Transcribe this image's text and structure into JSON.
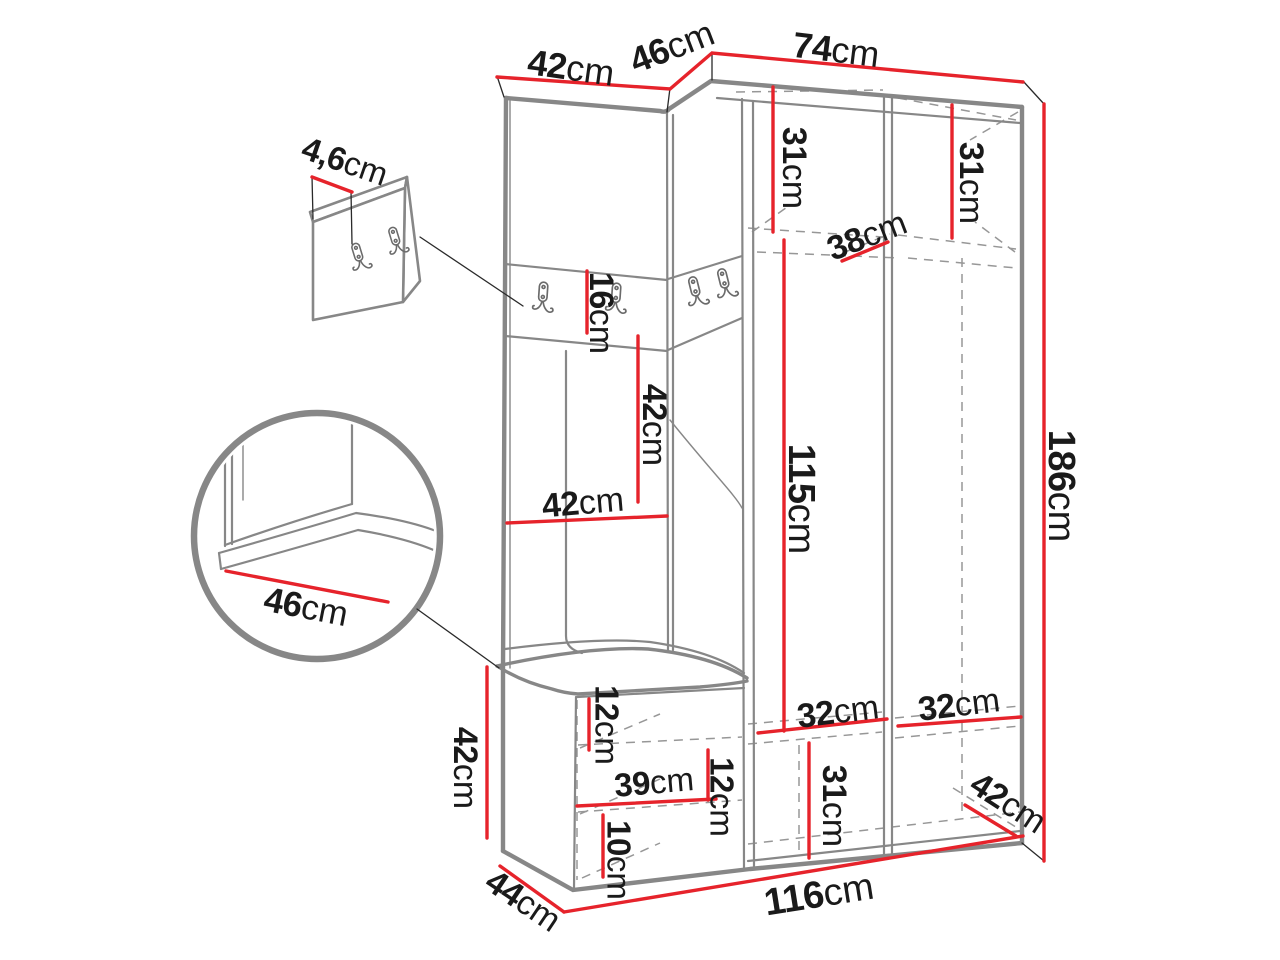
{
  "diagram": {
    "type": "furniture-dimension-drawing",
    "subject": "Corner hallway wardrobe set with coat hook panels, upholstered bench and shoe storage",
    "unit": "cm",
    "colors": {
      "background": "#ffffff",
      "outline_gray": "#878787",
      "hidden_line_gray": "#979797",
      "dimension_red": "#e6232b",
      "label_black": "#1a1a1a",
      "hook_gray": "#6b6b6b"
    },
    "icons": [
      "coat-hook-icon"
    ],
    "dimensions": [
      {
        "id": "width-left-section",
        "value": "42",
        "unit": "cm"
      },
      {
        "id": "width-corner-section",
        "value": "46",
        "unit": "cm"
      },
      {
        "id": "width-wardrobe",
        "value": "74",
        "unit": "cm"
      },
      {
        "id": "hook-panel-thickness",
        "value": "4,6",
        "unit": "cm"
      },
      {
        "id": "top-shelf-height-left",
        "value": "31",
        "unit": "cm"
      },
      {
        "id": "top-shelf-height-right",
        "value": "31",
        "unit": "cm"
      },
      {
        "id": "top-shelf-depth",
        "value": "38",
        "unit": "cm"
      },
      {
        "id": "hook-strip-height",
        "value": "16",
        "unit": "cm"
      },
      {
        "id": "back-panel-height",
        "value": "42",
        "unit": "cm"
      },
      {
        "id": "back-panel-width",
        "value": "42",
        "unit": "cm"
      },
      {
        "id": "hanging-space-height",
        "value": "115",
        "unit": "cm"
      },
      {
        "id": "total-height",
        "value": "186",
        "unit": "cm"
      },
      {
        "id": "bench-seat-depth",
        "value": "46",
        "unit": "cm"
      },
      {
        "id": "bench-height",
        "value": "42",
        "unit": "cm"
      },
      {
        "id": "bench-shelf-gap-upper",
        "value": "12",
        "unit": "cm"
      },
      {
        "id": "bench-inner-width",
        "value": "39",
        "unit": "cm"
      },
      {
        "id": "bench-shelf-gap-lower",
        "value": "12",
        "unit": "cm"
      },
      {
        "id": "bench-bottom-shelf-height",
        "value": "10",
        "unit": "cm"
      },
      {
        "id": "door-inner-width-left",
        "value": "32",
        "unit": "cm"
      },
      {
        "id": "door-inner-width-right",
        "value": "32",
        "unit": "cm"
      },
      {
        "id": "bottom-compartment-height",
        "value": "31",
        "unit": "cm"
      },
      {
        "id": "wardrobe-depth",
        "value": "42",
        "unit": "cm"
      },
      {
        "id": "bench-depth",
        "value": "44",
        "unit": "cm"
      },
      {
        "id": "total-width",
        "value": "116",
        "unit": "cm"
      }
    ]
  }
}
